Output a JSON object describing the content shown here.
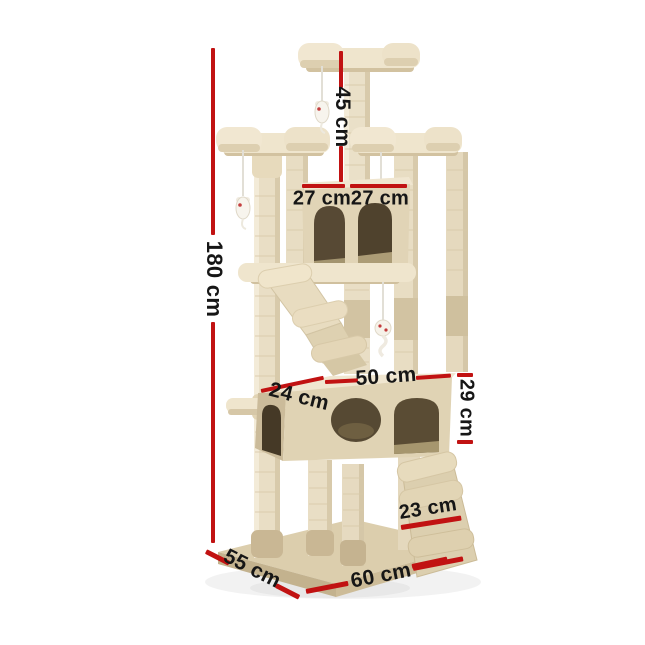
{
  "figure": {
    "type": "product dimension diagram",
    "subject": "cat tree tower with condos, perch platforms, ramps and hanging mouse toys"
  },
  "dimensions": {
    "total_height": "180 cm",
    "top_tier_height": "45 cm",
    "upper_condo_width_left": "27 cm",
    "upper_condo_width_right": "27 cm",
    "lower_condo_depth": "24 cm",
    "lower_condo_width": "50 cm",
    "lower_condo_height": "29 cm",
    "ramp_width": "23 cm",
    "base_depth": "55 cm",
    "base_width": "60 cm"
  },
  "colors": {
    "dimension_line": "#c11212",
    "label_text": "#161616",
    "plush_light": "#efe5cd",
    "plush_mid": "#e1d4b6",
    "plush_dark": "#cdbd9c",
    "sisal": "#e9dec5",
    "condo_interior": "#564934",
    "base_top": "#dccead",
    "background": "#ffffff"
  }
}
